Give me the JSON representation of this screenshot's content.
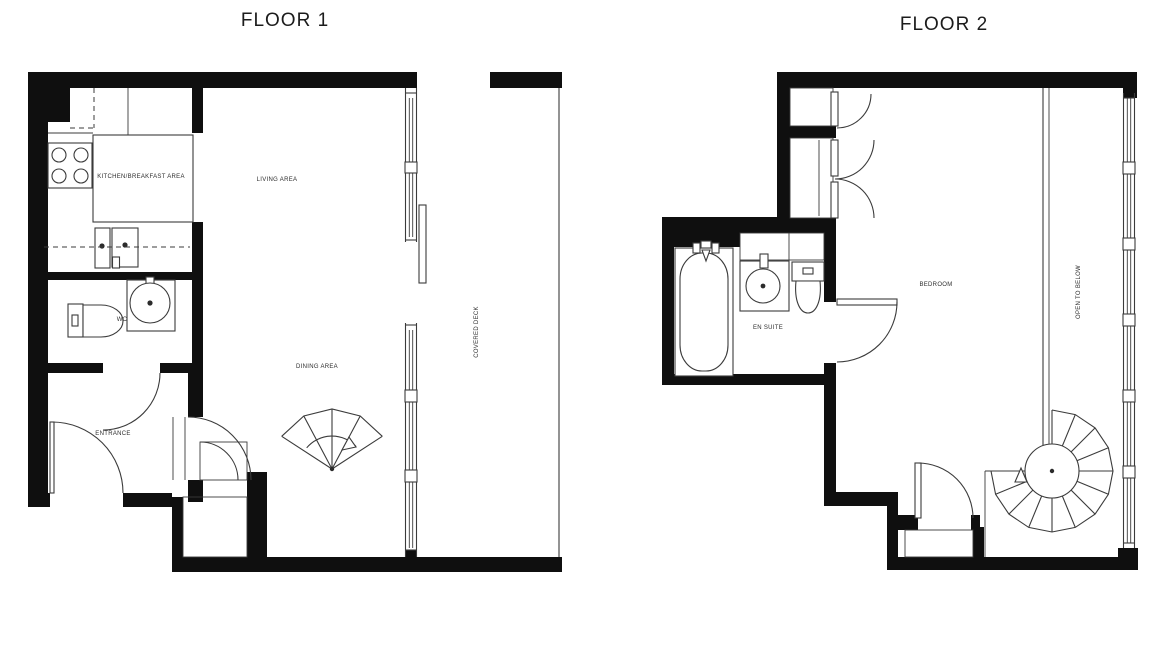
{
  "colors": {
    "background": "#ffffff",
    "wall": "#0f0f0f",
    "line": "#3b3b3b",
    "text": "#2e2e2e"
  },
  "floors": [
    {
      "title": "FLOOR 1",
      "labels": {
        "kitchen": "KITCHEN/BREAKFAST AREA",
        "living": "LIVING AREA",
        "dining": "DINING AREA",
        "wc": "WC",
        "entrance": "ENTRANCE",
        "deck": "COVERED DECK"
      }
    },
    {
      "title": "FLOOR 2",
      "labels": {
        "bedroom": "BEDROOM",
        "ensuite": "EN SUITE",
        "open_below": "OPEN TO BELOW"
      }
    }
  ]
}
